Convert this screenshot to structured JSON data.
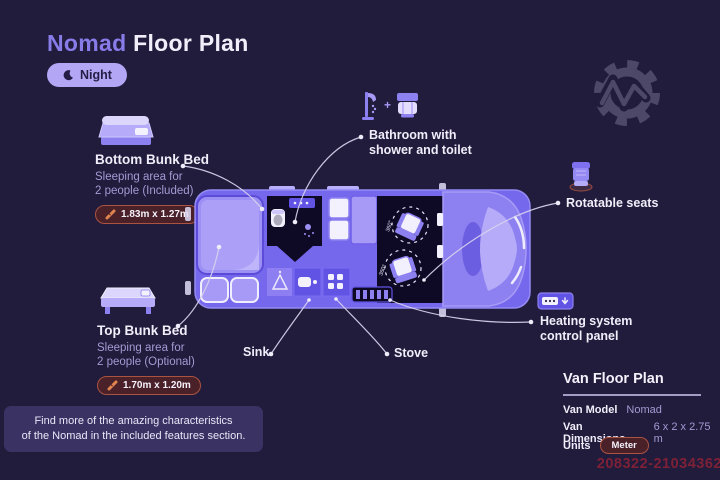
{
  "header": {
    "title_accent": "Nomad",
    "title_rest": " Floor Plan",
    "mode_label": "Night"
  },
  "features": {
    "bottom_bunk": {
      "title": "Bottom Bunk Bed",
      "desc_line1": "Sleeping area for",
      "desc_line2": "2 people (Included)",
      "dimensions": "1.83m x 1.27m"
    },
    "top_bunk": {
      "title": "Top Bunk Bed",
      "desc_line1": "Sleeping area for",
      "desc_line2": "2 people (Optional)",
      "dimensions": "1.70m x 1.20m"
    },
    "bathroom": {
      "line1": "Bathroom with",
      "line2": "shower and toilet",
      "plus": "+"
    },
    "rotatable_seats": {
      "label": "Rotatable seats"
    },
    "heating": {
      "line1": "Heating system",
      "line2": "control panel"
    },
    "sink": {
      "label": "Sink"
    },
    "stove": {
      "label": "Stove"
    }
  },
  "van": {
    "rotation_label": "360°"
  },
  "banner": {
    "line1": "Find more of the amazing characteristics",
    "line2": "of the Nomad in the included features section."
  },
  "info_panel": {
    "title": "Van Floor Plan",
    "rows": [
      {
        "label": "Van Model",
        "value": "Nomad"
      },
      {
        "label": "Van Dimensions",
        "value": "6 x 2 x 2.75 m"
      },
      {
        "label": "Units",
        "value": "Meter"
      }
    ]
  },
  "watermark": "208322-21034362",
  "colors": {
    "background": "#211b3c",
    "accent": "#877ce8",
    "night_pill": "#b3a6f4",
    "badge_bg": "#4a2029",
    "badge_border": "#aa5340",
    "van_body": "#7668ec",
    "furniture_light": "#a79af7",
    "unit_purple": "#6154e4",
    "muted_text": "#a49bd4",
    "watermark_red": "#7e2136"
  }
}
